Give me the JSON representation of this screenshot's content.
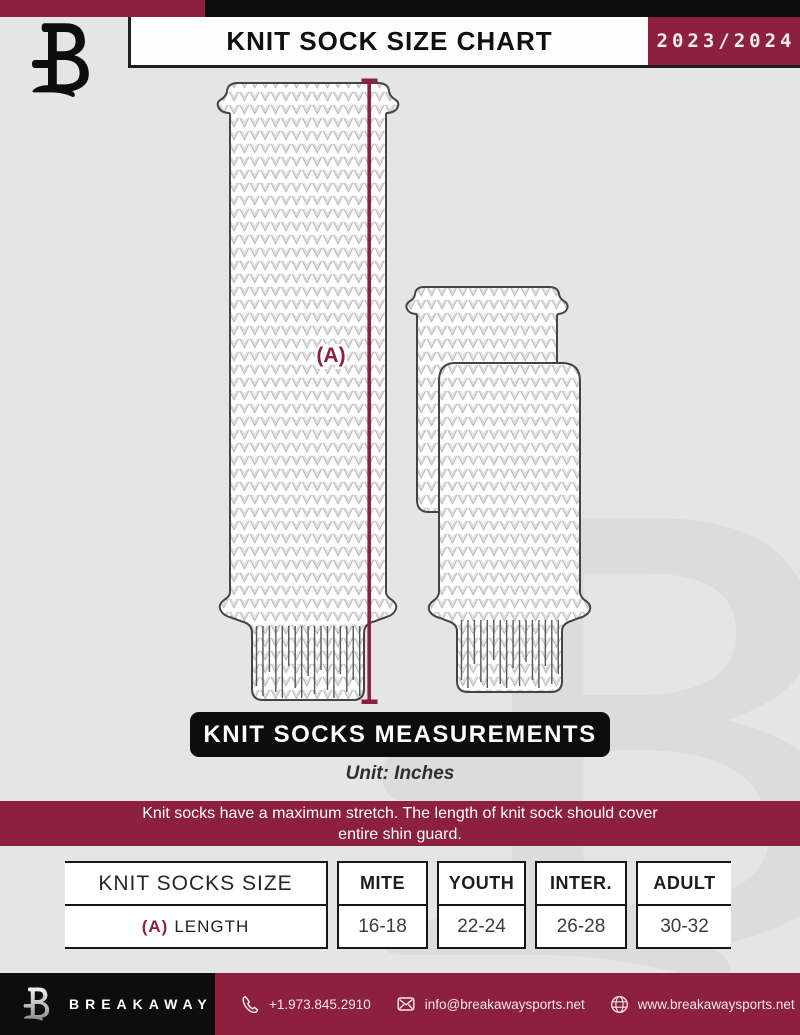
{
  "header": {
    "title": "KNIT SOCK SIZE CHART",
    "season": "2023/2024"
  },
  "illustration": {
    "measurement_label": "(A)"
  },
  "measurements": {
    "banner": "KNIT SOCKS MEASUREMENTS",
    "unit": "Unit: Inches"
  },
  "notice": {
    "line1": "Knit socks have a maximum stretch. The length of knit sock should cover",
    "line2": "entire shin guard."
  },
  "size_table": {
    "header": [
      "KNIT SOCKS SIZE",
      "MITE",
      "YOUTH",
      "INTER.",
      "ADULT"
    ],
    "rows": [
      {
        "label_prefix": "(A)",
        "label": "LENGTH",
        "values": [
          "16-18",
          "22-24",
          "26-28",
          "30-32"
        ]
      }
    ]
  },
  "footer": {
    "brand": "BREAKAWAY",
    "phone": "+1.973.845.2910",
    "email": "info@breakawaysports.net",
    "website": "www.breakawaysports.net"
  },
  "colors": {
    "maroon": "#8D1F40",
    "black": "#0D0D0D",
    "background": "#E4E5E4"
  }
}
